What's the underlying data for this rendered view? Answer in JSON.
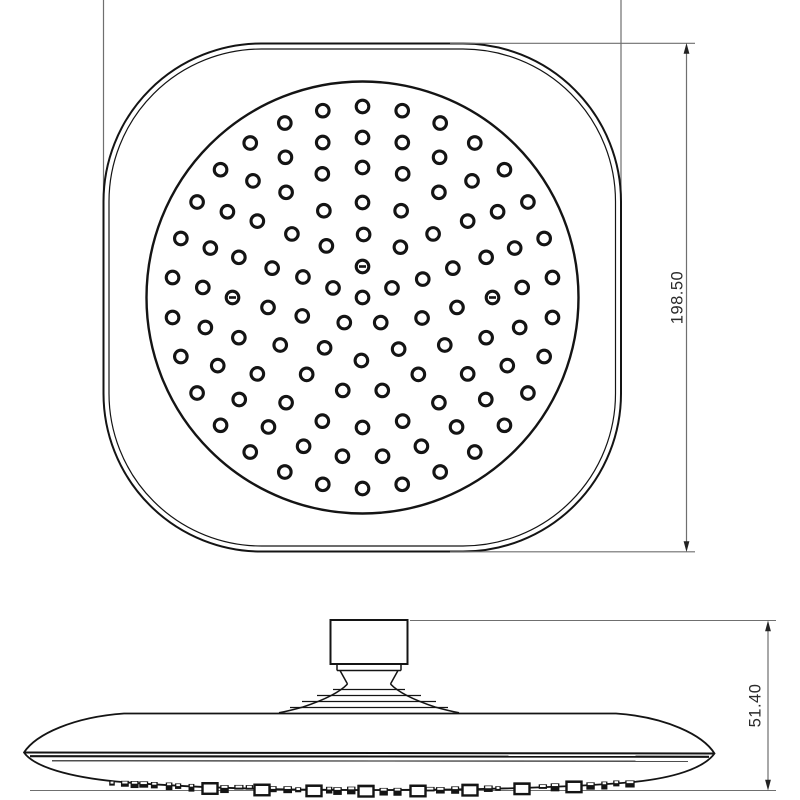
{
  "meta": {
    "title": "Overhead rain shower head - dimensioned technical drawing",
    "background": "#ffffff",
    "line_color": "#141414",
    "dim_line_color": "#6f6f6f",
    "arrow_color": "#222222",
    "text_color": "#2b2b2b"
  },
  "annotations": {
    "top_view_height": {
      "label": "198.50"
    },
    "side_view_height": {
      "label": "51.40"
    }
  },
  "top_view": {
    "body": {
      "x": 103.5,
      "y": 43.5,
      "width": 517.5,
      "height": 508,
      "corner_radius": 158,
      "inner_inset": 5.5
    },
    "face_plate": {
      "cx": 362.5,
      "cy": 297.5,
      "r": 216
    },
    "nozzle_style": {
      "outer_radius": 6.3,
      "ring_stroke": 3.1,
      "mark_width": 7,
      "mark_height": 2.6
    },
    "nozzle_rings": [
      {
        "radius": 0,
        "count": 1,
        "offset_deg": 0
      },
      {
        "radius": 31,
        "count": 5,
        "offset_deg": 90,
        "marked_angles": [
          90
        ]
      },
      {
        "radius": 63,
        "count": 10,
        "offset_deg": 17
      },
      {
        "radius": 95,
        "count": 15,
        "offset_deg": 18
      },
      {
        "radius": 130,
        "count": 20,
        "offset_deg": 0,
        "marked_angles": [
          0,
          180
        ]
      },
      {
        "radius": 160,
        "count": 25,
        "offset_deg": 3.6
      },
      {
        "radius": 191,
        "count": 30,
        "offset_deg": 6
      }
    ]
  },
  "side_view": {
    "bumps": {
      "seed": 7,
      "x_start": 112,
      "x_end": 634,
      "center_x": 371,
      "base_y": 787.5,
      "sag": 9500,
      "spacing": 11.5,
      "big_x": [
        210,
        262,
        314,
        366,
        418,
        470,
        522,
        574
      ]
    }
  }
}
